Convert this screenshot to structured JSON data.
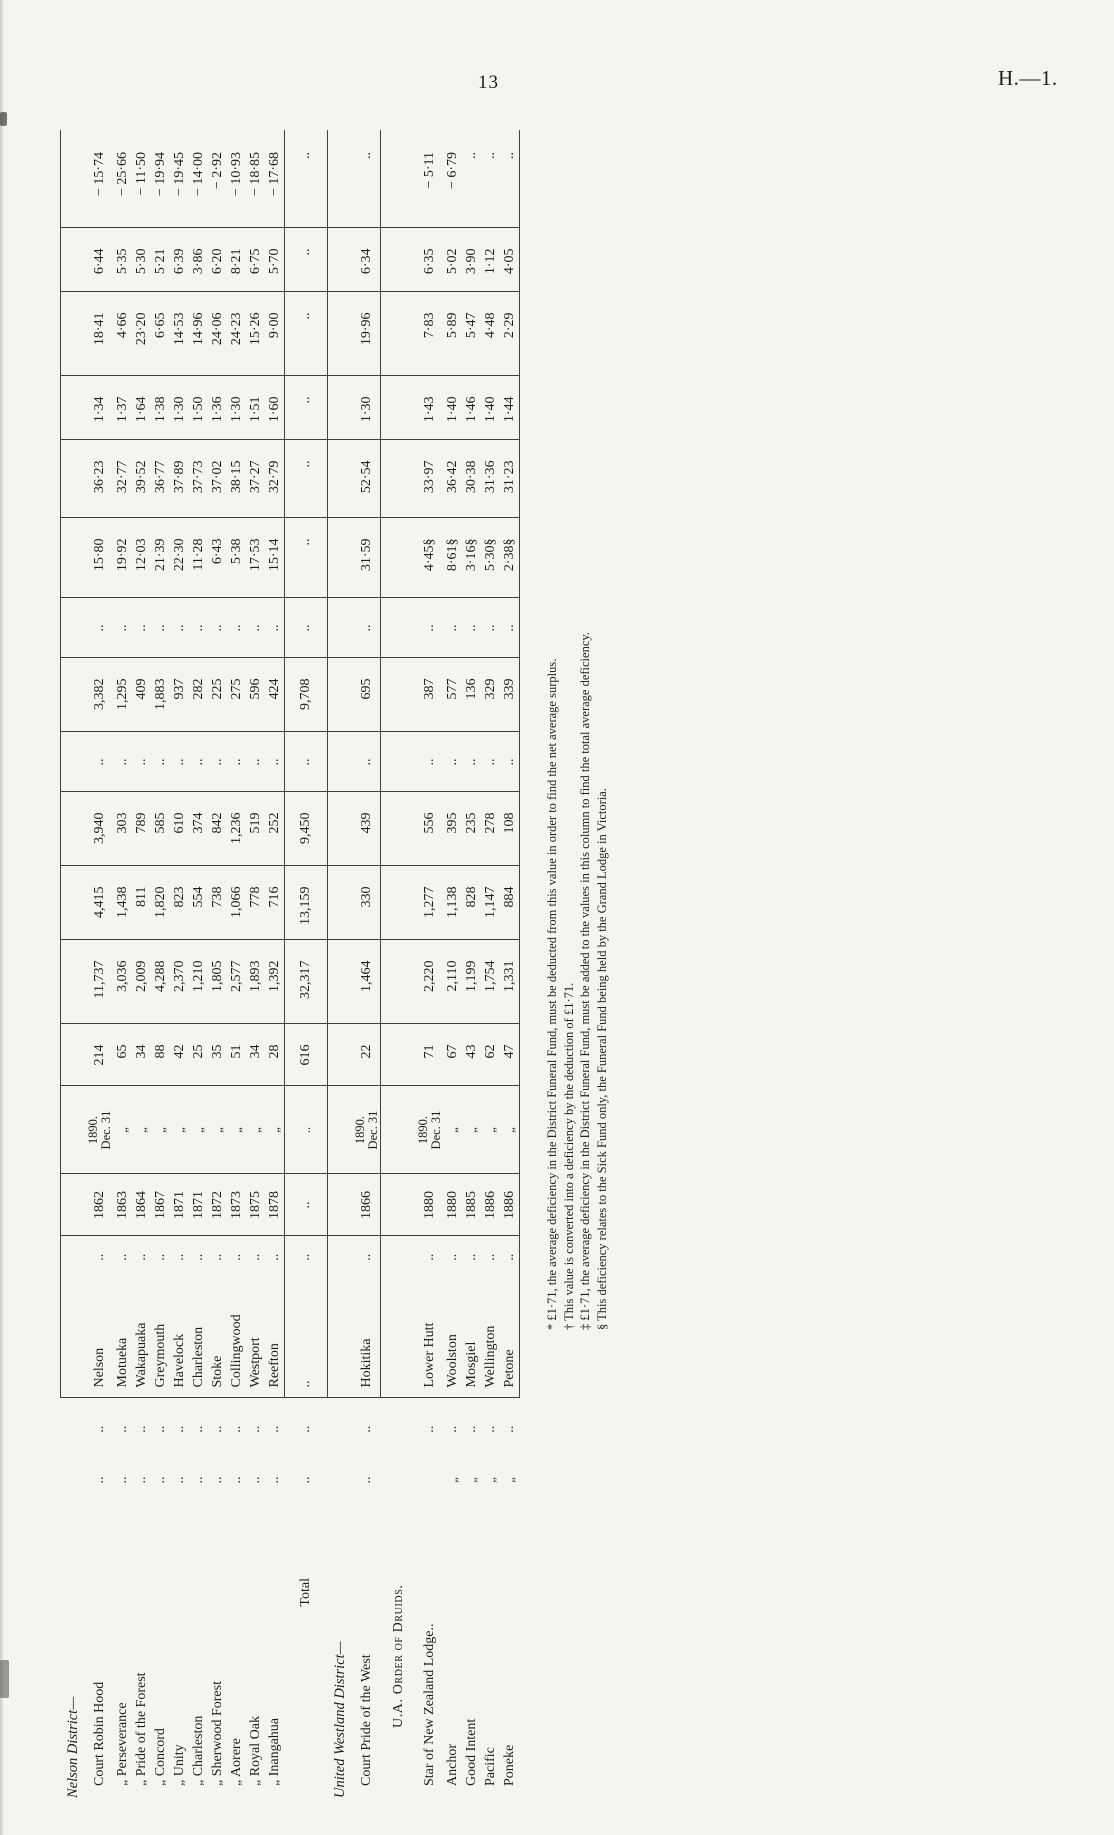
{
  "page": {
    "number": "13",
    "paper_ref": "H.—1."
  },
  "table": {
    "rows": [
      {
        "type": "section",
        "name": "Nelson District—"
      },
      {
        "type": "data",
        "name": "Court Robin Hood",
        "d1": "..",
        "d2": "..",
        "place": "Nelson",
        "d3": "..",
        "year": "1862",
        "date": "1890.\nDec. 31",
        "members": "214",
        "c1": "11,737",
        "c2": "4,415",
        "c3": "3,940",
        "b1": "..",
        "c4": "3,382",
        "b2": "..",
        "a1": "15·80",
        "a2": "36·23",
        "a3": "1·34",
        "a4": "18·41",
        "a5": "6·44",
        "a6": "− 15·74"
      },
      {
        "type": "data",
        "name": "„  Perseverance",
        "d1": "..",
        "d2": "..",
        "place": "Motueka",
        "d3": "..",
        "year": "1863",
        "date": "„",
        "members": "65",
        "c1": "3,036",
        "c2": "1,438",
        "c3": "303",
        "b1": "..",
        "c4": "1,295",
        "b2": "..",
        "a1": "19·92",
        "a2": "32·77",
        "a3": "1·37",
        "a4": "4·66",
        "a5": "5·35",
        "a6": "− 25·66"
      },
      {
        "type": "data",
        "name": "„  Pride of the Forest",
        "d1": "..",
        "d2": "..",
        "place": "Wakapuaka",
        "d3": "..",
        "year": "1864",
        "date": "„",
        "members": "34",
        "c1": "2,009",
        "c2": "811",
        "c3": "789",
        "b1": "..",
        "c4": "409",
        "b2": "..",
        "a1": "12·03",
        "a2": "39·52",
        "a3": "1·64",
        "a4": "23·20",
        "a5": "5·30",
        "a6": "− 11·50"
      },
      {
        "type": "data",
        "name": "„  Concord",
        "d1": "..",
        "d2": "..",
        "place": "Greymouth",
        "d3": "..",
        "year": "1867",
        "date": "„",
        "members": "88",
        "c1": "4,288",
        "c2": "1,820",
        "c3": "585",
        "b1": "..",
        "c4": "1,883",
        "b2": "..",
        "a1": "21·39",
        "a2": "36·77",
        "a3": "1·38",
        "a4": "6·65",
        "a5": "5·21",
        "a6": "− 19·94"
      },
      {
        "type": "data",
        "name": "„  Unity",
        "d1": "..",
        "d2": "..",
        "place": "Havelock",
        "d3": "..",
        "year": "1871",
        "date": "„",
        "members": "42",
        "c1": "2,370",
        "c2": "823",
        "c3": "610",
        "b1": "..",
        "c4": "937",
        "b2": "..",
        "a1": "22·30",
        "a2": "37·89",
        "a3": "1·30",
        "a4": "14·53",
        "a5": "6·39",
        "a6": "− 19·45"
      },
      {
        "type": "data",
        "name": "„  Charleston",
        "d1": "..",
        "d2": "..",
        "place": "Charleston",
        "d3": "..",
        "year": "1871",
        "date": "„",
        "members": "25",
        "c1": "1,210",
        "c2": "554",
        "c3": "374",
        "b1": "..",
        "c4": "282",
        "b2": "..",
        "a1": "11·28",
        "a2": "37·73",
        "a3": "1·50",
        "a4": "14·96",
        "a5": "3·86",
        "a6": "− 14·00"
      },
      {
        "type": "data",
        "name": "„  Sherwood Forest",
        "d1": "..",
        "d2": "..",
        "place": "Stoke",
        "d3": "..",
        "year": "1872",
        "date": "„",
        "members": "35",
        "c1": "1,805",
        "c2": "738",
        "c3": "842",
        "b1": "..",
        "c4": "225",
        "b2": "..",
        "a1": "6·43",
        "a2": "37·02",
        "a3": "1·36",
        "a4": "24·06",
        "a5": "6·20",
        "a6": "− 2·92"
      },
      {
        "type": "data",
        "name": "„  Aorere",
        "d1": "..",
        "d2": "..",
        "place": "Collingwood",
        "d3": "..",
        "year": "1873",
        "date": "„",
        "members": "51",
        "c1": "2,577",
        "c2": "1,066",
        "c3": "1,236",
        "b1": "..",
        "c4": "275",
        "b2": "..",
        "a1": "5·38",
        "a2": "38·15",
        "a3": "1·30",
        "a4": "24·23",
        "a5": "8·21",
        "a6": "− 10·93"
      },
      {
        "type": "data",
        "name": "„  Royal Oak",
        "d1": "..",
        "d2": "..",
        "place": "Westport",
        "d3": "..",
        "year": "1875",
        "date": "„",
        "members": "34",
        "c1": "1,893",
        "c2": "778",
        "c3": "519",
        "b1": "..",
        "c4": "596",
        "b2": "..",
        "a1": "17·53",
        "a2": "37·27",
        "a3": "1·51",
        "a4": "15·26",
        "a5": "6·75",
        "a6": "− 18·85"
      },
      {
        "type": "data",
        "name": "„  Inangahua",
        "d1": "..",
        "d2": "..",
        "place": "Reefton",
        "d3": "..",
        "year": "1878",
        "date": "„",
        "members": "28",
        "c1": "1,392",
        "c2": "716",
        "c3": "252",
        "b1": "..",
        "c4": "424",
        "b2": "..",
        "a1": "15·14",
        "a2": "32·79",
        "a3": "1·60",
        "a4": "9·00",
        "a5": "5·70",
        "a6": "− 17·68"
      },
      {
        "type": "total",
        "name": "Total",
        "d1": "..",
        "d2": "..",
        "place": "..",
        "d3": "..",
        "year": "..",
        "date": "..",
        "members": "616",
        "c1": "32,317",
        "c2": "13,159",
        "c3": "9,450",
        "b1": "..",
        "c4": "9,708",
        "b2": "..",
        "a1": "..",
        "a2": "..",
        "a3": "..",
        "a4": "..",
        "a5": "..",
        "a6": ".."
      },
      {
        "type": "section",
        "name": "United Westland District—"
      },
      {
        "type": "hok",
        "name": "Court Pride of the West",
        "d1": "..",
        "d2": "..",
        "place": "Hokitika",
        "d3": "..",
        "year": "1866",
        "date": "1890.\nDec. 31",
        "members": "22",
        "c1": "1,464",
        "c2": "330",
        "c3": "439",
        "b1": "..",
        "c4": "695",
        "b2": "..",
        "a1": "31·59",
        "a2": "52·54",
        "a3": "1·30",
        "a4": "19·96",
        "a5": "6·34",
        "a6": ".."
      },
      {
        "type": "druids",
        "name": "U.A. Order of Druids."
      },
      {
        "type": "data",
        "name": "Star of New Zealand Lodge..",
        "d1": "",
        "d2": "..",
        "place": "Lower Hutt",
        "d3": "..",
        "year": "1880",
        "date": "1890.\nDec. 31",
        "members": "71",
        "c1": "2,220",
        "c2": "1,277",
        "c3": "556",
        "b1": "..",
        "c4": "387",
        "b2": "..",
        "a1": "4·45§",
        "a2": "33·97",
        "a3": "1·43",
        "a4": "7·83",
        "a5": "6·35",
        "a6": "− 5·11"
      },
      {
        "type": "data",
        "name": "Anchor",
        "d1": "„",
        "d2": "..",
        "place": "Woolston",
        "d3": "..",
        "year": "1880",
        "date": "„",
        "members": "67",
        "c1": "2,110",
        "c2": "1,138",
        "c3": "395",
        "b1": "..",
        "c4": "577",
        "b2": "..",
        "a1": "8·61§",
        "a2": "36·42",
        "a3": "1·40",
        "a4": "5·89",
        "a5": "5·02",
        "a6": "− 6·79"
      },
      {
        "type": "data",
        "name": "Good Intent",
        "d1": "„",
        "d2": "..",
        "place": "Mosgiel",
        "d3": "..",
        "year": "1885",
        "date": "„",
        "members": "43",
        "c1": "1,199",
        "c2": "828",
        "c3": "235",
        "b1": "..",
        "c4": "136",
        "b2": "..",
        "a1": "3·16§",
        "a2": "30·38",
        "a3": "1·46",
        "a4": "5·47",
        "a5": "3·90",
        "a6": ".."
      },
      {
        "type": "data",
        "name": "Pacific",
        "d1": "„",
        "d2": "..",
        "place": "Wellington",
        "d3": "..",
        "year": "1886",
        "date": "„",
        "members": "62",
        "c1": "1,754",
        "c2": "1,147",
        "c3": "278",
        "b1": "..",
        "c4": "329",
        "b2": "..",
        "a1": "5·30§",
        "a2": "31·36",
        "a3": "1·40",
        "a4": "4·48",
        "a5": "1·12",
        "a6": ".."
      },
      {
        "type": "data",
        "name": "Poneke",
        "d1": "„",
        "d2": "..",
        "place": "Petone",
        "d3": "..",
        "year": "1886",
        "date": "„",
        "members": "47",
        "c1": "1,331",
        "c2": "884",
        "c3": "108",
        "b1": "..",
        "c4": "339",
        "b2": "..",
        "a1": "2·38§",
        "a2": "31·23",
        "a3": "1·44",
        "a4": "2·29",
        "a5": "4·05",
        "a6": ".."
      }
    ]
  },
  "footnotes": [
    "* £1·71, the average deficiency in the District Funeral Fund, must be deducted from this value in order to find the net average surplus.",
    "† This value is converted into a deficiency by the deduction of £1·71.",
    "‡ £1·71, the average deficiency in the District Funeral Fund, must be added to the values in this column to find the total average deficiency.",
    "§ This deficiency relates to the Sick Fund only, the Funeral Fund being held by the Grand Lodge in Victoria."
  ]
}
